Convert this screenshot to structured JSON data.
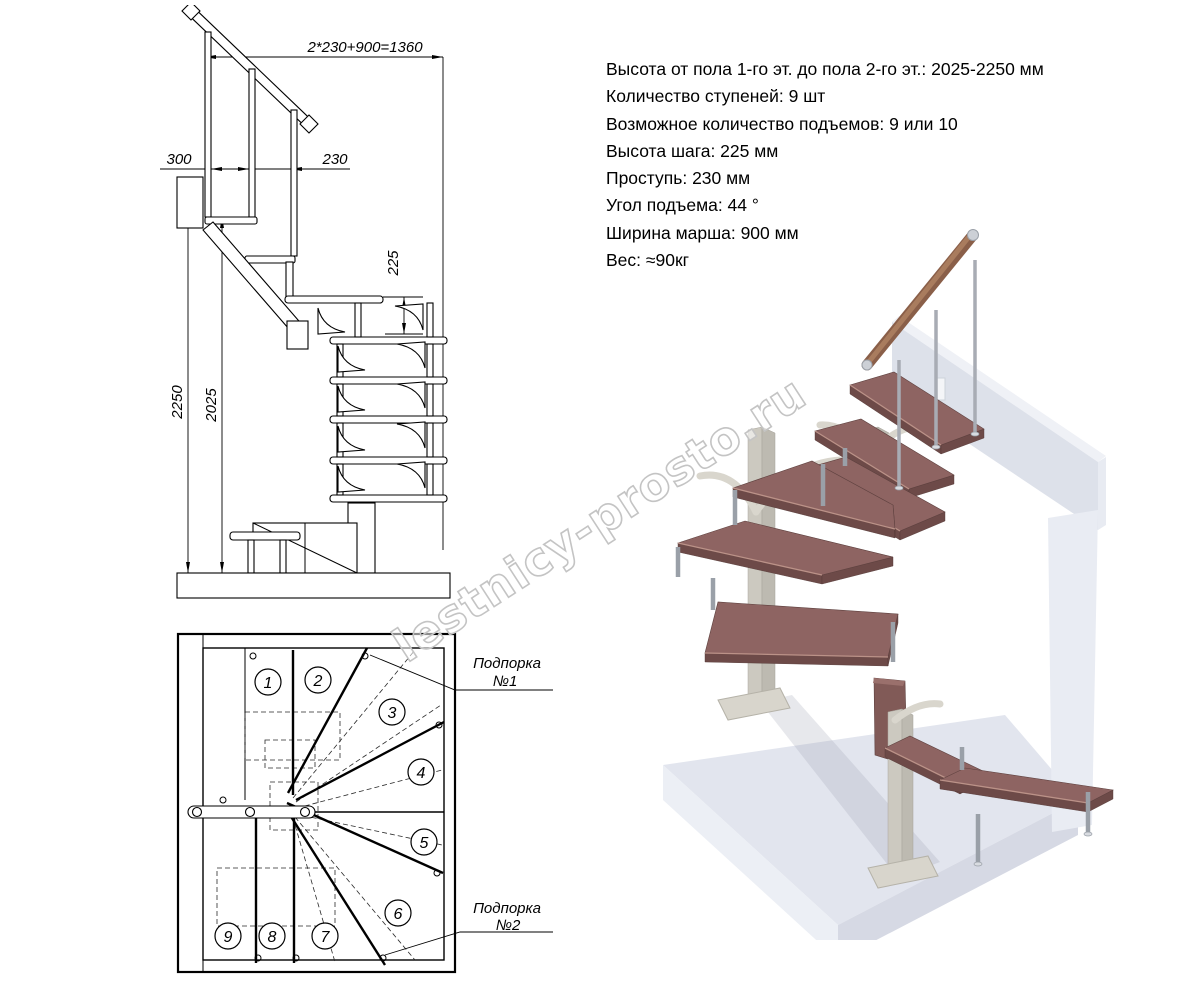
{
  "specs": {
    "lines": [
      "Высота от пола 1-го эт. до пола 2-го эт.: 2025-2250 мм",
      "Количество ступеней: 9 шт",
      "Возможное количество подъемов: 9 или 10",
      "Высота шага: 225 мм",
      "Проступь: 230 мм",
      "Угол подъема: 44 °",
      "Ширина марша: 900 мм",
      "Вес: ≈90кг"
    ]
  },
  "elevation": {
    "dim_total": "2*230+900=1360",
    "dim_overhang": "300",
    "dim_tread": "230",
    "dim_rise": "225",
    "dim_height_max": "2250",
    "dim_height_min": "2025"
  },
  "plan": {
    "steps": [
      "1",
      "2",
      "3",
      "4",
      "5",
      "6",
      "7",
      "8",
      "9"
    ],
    "support1": {
      "line1": "Подпорка",
      "line2": "№1"
    },
    "support2": {
      "line1": "Подпорка",
      "line2": "№2"
    }
  },
  "watermark": {
    "text": "lestnicy-prosto.ru"
  },
  "colors": {
    "tread_top": "#8e6462",
    "tread_front": "#6d4a48",
    "metal": "#a8acb4",
    "column": "#ccc9c0",
    "floor": "#e2e5ee",
    "wall": "#dde1ea",
    "watermark": "#c4c4c4",
    "line": "#000000"
  }
}
